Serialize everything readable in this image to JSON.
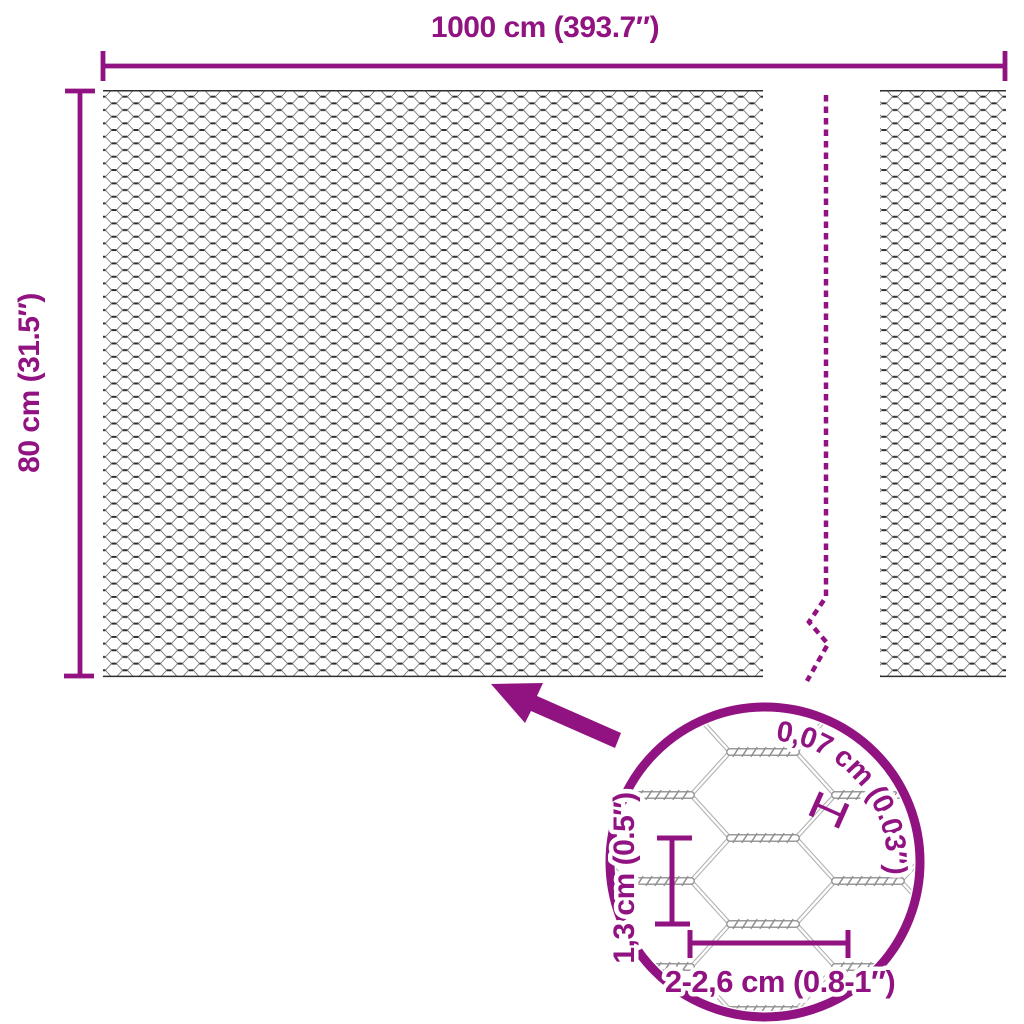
{
  "diagram": {
    "type": "product-dimension-diagram",
    "subject": "hexagonal wire mesh fence roll",
    "width_label": "1000 cm (393.7″)",
    "height_label": "80 cm (31.5″)",
    "magnifier": {
      "wire_thickness_label": "0,07 cm (0.03″)",
      "cell_height_label": "1,3 cm (0.5″)",
      "cell_width_label": "2-2,6 cm (0.8-1″)"
    }
  },
  "colors": {
    "accent": "#911381",
    "background": "#ffffff",
    "mesh_dark": "#2e2e2e",
    "mesh_mid": "#696969",
    "magnifier_wire": "#b4b4b4",
    "magnifier_twist": "#9a9a9a"
  }
}
